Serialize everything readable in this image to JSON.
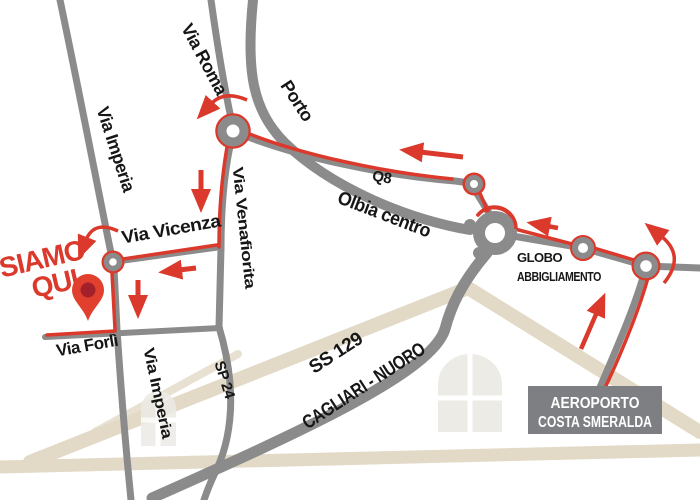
{
  "map": {
    "streets": {
      "via_roma": "Via Roma",
      "via_imperia_top": "Via Imperia",
      "porto": "Porto",
      "q8": "Q8",
      "olbia_centro": "Olbia centro",
      "via_venafiorita": "Via Venafiorita",
      "via_vicenza": "Via Vicenza",
      "via_forli": "Via Forlì",
      "via_imperia_bottom": "Via Imperia",
      "sp24": "SP 24",
      "ss129": "SS 129",
      "cagliari_nuoro": "CAGLIARI - NUORO"
    },
    "pois": {
      "globo_line1": "GLOBO",
      "globo_line2": "ABBIGLIAMENTO",
      "airport_line1": "AEROPORTO",
      "airport_line2": "COSTA SMERALDA"
    },
    "marker": {
      "line1": "SIAMO",
      "line2": "QUI"
    }
  },
  "colors": {
    "bg": "#ffffff",
    "road": "#8b8b8b",
    "route": "#da392b",
    "label": "#161616",
    "marker_text": "#da392b",
    "pin_fill": "#e2402e",
    "pin_core": "#a1202a",
    "box_bg": "#7d7f83",
    "box_text": "#ffffff",
    "house": "#e2d9c7",
    "window": "#edebe6"
  }
}
